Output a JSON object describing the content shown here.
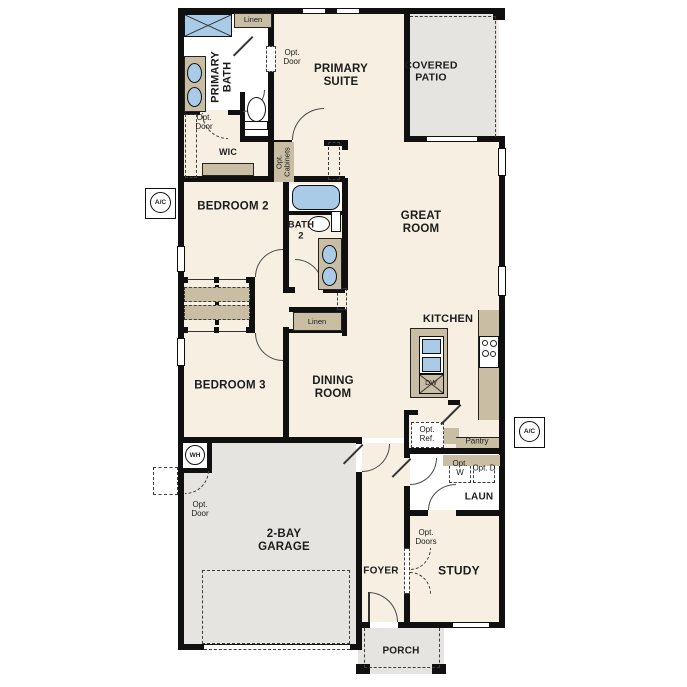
{
  "labels": {
    "primary_bath": "PRIMARY BATH",
    "linen_1": "Linen",
    "opt_door_1": "Opt. Door",
    "primary_suite": "PRIMARY SUITE",
    "covered_patio": "COVERED PATIO",
    "opt_door_2": "Opt. Door",
    "wic": "WIC",
    "opt_cabinets": "Opt. Cabinets",
    "ac_left": "A/C",
    "bedroom_2": "BEDROOM 2",
    "bath_2": "BATH 2",
    "great_room": "GREAT ROOM",
    "linen_2": "Linen",
    "bedroom_3": "BEDROOM 3",
    "dining_room": "DINING ROOM",
    "kitchen": "KITCHEN",
    "dw": "DW",
    "opt_ref": "Opt. Ref.",
    "pantry": "Pantry",
    "ac_right": "A/C",
    "opt_w": "Opt. W",
    "opt_d": "Opt. D",
    "laundry": "LAUN",
    "wh": "WH",
    "opt_door_3": "Opt. Door",
    "garage": "2-BAY GARAGE",
    "foyer": "FOYER",
    "opt_doors": "Opt. Doors",
    "study": "STUDY",
    "porch": "PORCH"
  },
  "colors": {
    "wall": "#101010",
    "floor": "#f6efe2",
    "outdoor": "#e5e4e1",
    "cabinet": "#c9bda3",
    "fixture_blue": "#a9cbe8",
    "text": "#1c1c1c"
  }
}
